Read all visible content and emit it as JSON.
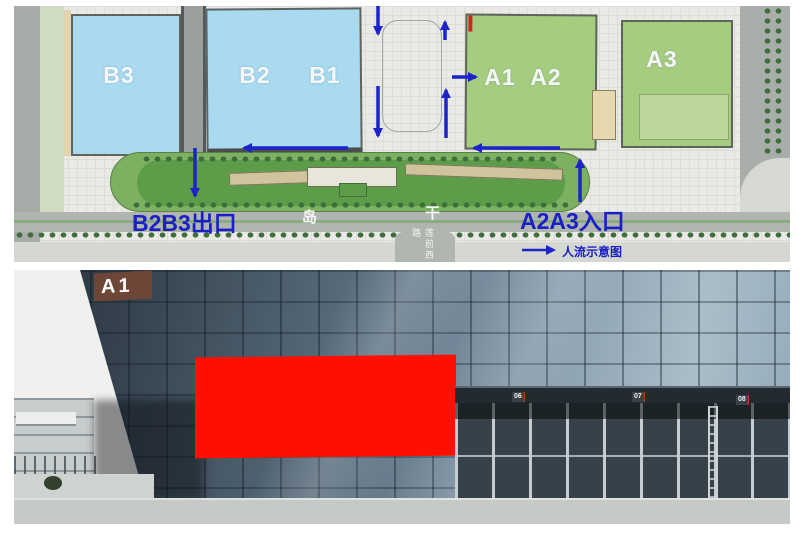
{
  "site_plan": {
    "building_labels": {
      "b3": "B3",
      "b2": "B2",
      "b1": "B1",
      "a1": "A1",
      "a2": "A2",
      "a3": "A3"
    },
    "exit_label": "B2B3出口",
    "entrance_label": "A2A3入口",
    "legend_label": "人流示意图",
    "road_char_1": "岛",
    "road_char_2": "干",
    "vertical_road_name": "莲前西路",
    "colors": {
      "flow_arrow": "#1b23c9",
      "blue_building": "#a9daf0",
      "green_building": "#a6cc80",
      "island_green": "#7cb161"
    }
  },
  "photo": {
    "facade_sign": "A1",
    "billboard_color": "#fe0f00",
    "gate_signs": [
      {
        "prefix": "A1",
        "number": "06"
      },
      {
        "prefix": "A1",
        "number": "07"
      },
      {
        "prefix": "A1",
        "number": "08"
      }
    ]
  }
}
